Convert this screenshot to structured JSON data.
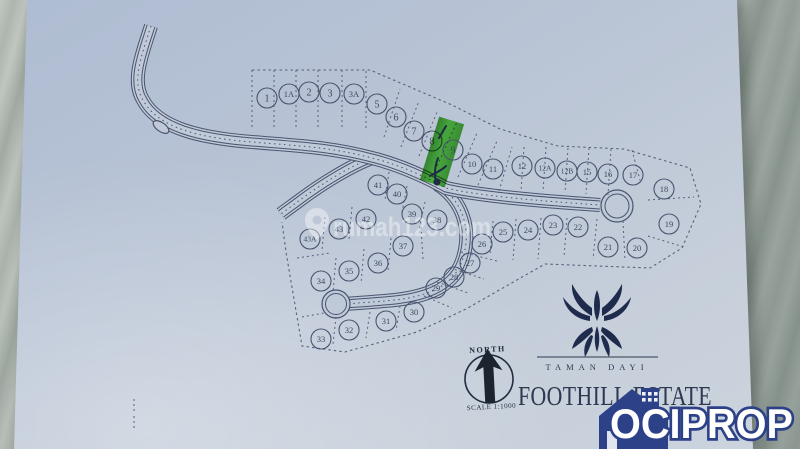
{
  "image_type": "photographed housing estate site plan on marble surface",
  "watermark": {
    "icon": "map-pin-icon",
    "text": "rumah123.com"
  },
  "site_plan": {
    "north_label": "NORTH",
    "scale_label": "SCALE 1:1000",
    "highlighted_lot": "9",
    "lots": [
      {
        "n": "1",
        "x": 267,
        "y": 98
      },
      {
        "n": "1A",
        "x": 289,
        "y": 94
      },
      {
        "n": "2",
        "x": 309,
        "y": 92
      },
      {
        "n": "3",
        "x": 330,
        "y": 93
      },
      {
        "n": "3A",
        "x": 354,
        "y": 94
      },
      {
        "n": "5",
        "x": 377,
        "y": 104
      },
      {
        "n": "6",
        "x": 396,
        "y": 117
      },
      {
        "n": "7",
        "x": 414,
        "y": 131
      },
      {
        "n": "8",
        "x": 432,
        "y": 141
      },
      {
        "n": "9",
        "x": 453,
        "y": 150
      },
      {
        "n": "10",
        "x": 472,
        "y": 164
      },
      {
        "n": "11",
        "x": 493,
        "y": 169
      },
      {
        "n": "12",
        "x": 522,
        "y": 166
      },
      {
        "n": "12A",
        "x": 545,
        "y": 168
      },
      {
        "n": "12B",
        "x": 567,
        "y": 171
      },
      {
        "n": "15",
        "x": 587,
        "y": 172
      },
      {
        "n": "16",
        "x": 608,
        "y": 174
      },
      {
        "n": "17",
        "x": 633,
        "y": 175
      },
      {
        "n": "18",
        "x": 664,
        "y": 189
      },
      {
        "n": "19",
        "x": 669,
        "y": 224
      },
      {
        "n": "20",
        "x": 637,
        "y": 248
      },
      {
        "n": "21",
        "x": 608,
        "y": 247
      },
      {
        "n": "22",
        "x": 578,
        "y": 227
      },
      {
        "n": "23",
        "x": 553,
        "y": 225
      },
      {
        "n": "24",
        "x": 528,
        "y": 230
      },
      {
        "n": "25",
        "x": 503,
        "y": 232
      },
      {
        "n": "26",
        "x": 482,
        "y": 244
      },
      {
        "n": "27",
        "x": 470,
        "y": 263
      },
      {
        "n": "28",
        "x": 454,
        "y": 277
      },
      {
        "n": "29",
        "x": 436,
        "y": 288
      },
      {
        "n": "30",
        "x": 414,
        "y": 312
      },
      {
        "n": "31",
        "x": 386,
        "y": 321
      },
      {
        "n": "32",
        "x": 349,
        "y": 330
      },
      {
        "n": "33",
        "x": 321,
        "y": 339
      },
      {
        "n": "34",
        "x": 321,
        "y": 281
      },
      {
        "n": "35",
        "x": 349,
        "y": 271
      },
      {
        "n": "36",
        "x": 378,
        "y": 263
      },
      {
        "n": "37",
        "x": 403,
        "y": 246
      },
      {
        "n": "38",
        "x": 437,
        "y": 220
      },
      {
        "n": "39",
        "x": 412,
        "y": 214
      },
      {
        "n": "40",
        "x": 397,
        "y": 194
      },
      {
        "n": "41",
        "x": 378,
        "y": 185
      },
      {
        "n": "42",
        "x": 366,
        "y": 219
      },
      {
        "n": "43",
        "x": 339,
        "y": 229
      },
      {
        "n": "43A",
        "x": 310,
        "y": 239
      }
    ]
  },
  "branding": {
    "developer_name": "TAMAN DAYI",
    "estate_name": "FOOTHILL ESTATE",
    "agency_name": "OCIPROP"
  },
  "colors": {
    "paper": "#c2cbd8",
    "ink": "#4a5470",
    "highlight_green": "#3ec228",
    "logo_navy": "#2c4187",
    "marble": "#a9b2ac"
  }
}
